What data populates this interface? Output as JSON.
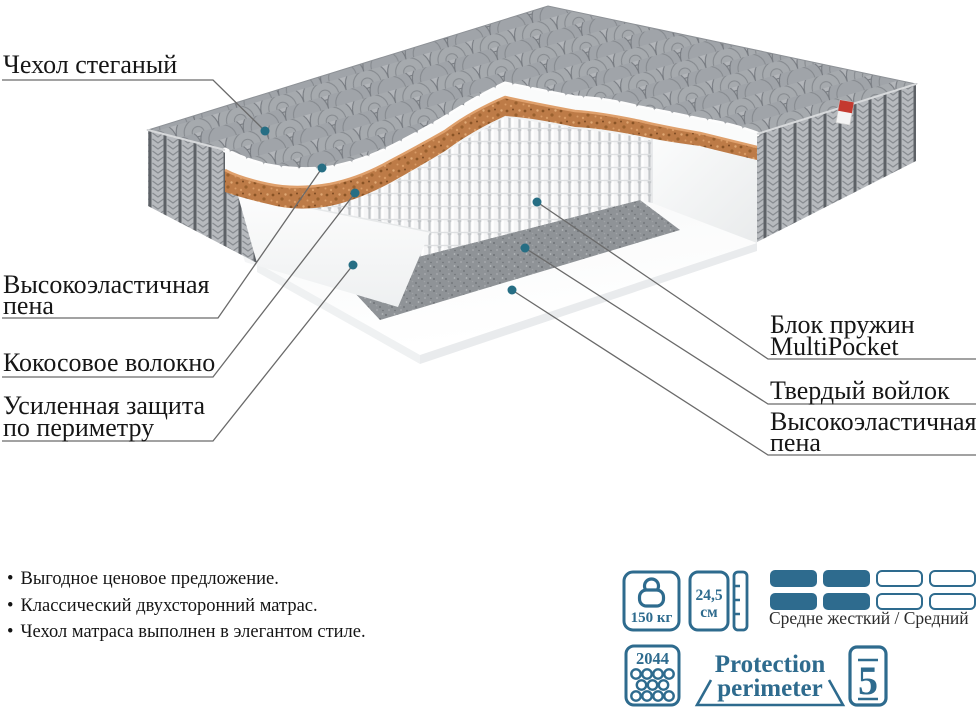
{
  "colors": {
    "accent": "#2e6b8e",
    "callout_dot": "#266e84",
    "line": "#6a6a6a",
    "coco_brown": "#bd7b47",
    "felt_gray": "#8e9296",
    "quilt_gray": "#aeb2b6"
  },
  "callouts": {
    "left": [
      {
        "line1": "Чехол стеганый",
        "line2": ""
      },
      {
        "line1": "Высокоэластичная",
        "line2": "пена"
      },
      {
        "line1": "Кокосовое волокно",
        "line2": ""
      },
      {
        "line1": "Усиленная защита",
        "line2": "по периметру"
      }
    ],
    "right": [
      {
        "line1": "Блок пружин",
        "line2": "MultiPocket"
      },
      {
        "line1": "Твердый войлок",
        "line2": ""
      },
      {
        "line1": "Высокоэластичная",
        "line2": "пена"
      }
    ]
  },
  "features": {
    "bullet": "•",
    "items": [
      "Выгодное ценовое предложение.",
      "Классический двухсторонний матрас.",
      "Чехол матраса выполнен в элегантом стиле."
    ]
  },
  "specs": {
    "max_weight": "150 кг",
    "height_value": "24,5",
    "height_unit": "см",
    "firmness_label": "Средне жесткий / Средний",
    "firmness_filled_columns": 2,
    "firmness_total_columns": 4,
    "springs_count": "2044",
    "logo_line1": "Protection",
    "logo_line2": "perimeter",
    "warranty_years": "5"
  }
}
